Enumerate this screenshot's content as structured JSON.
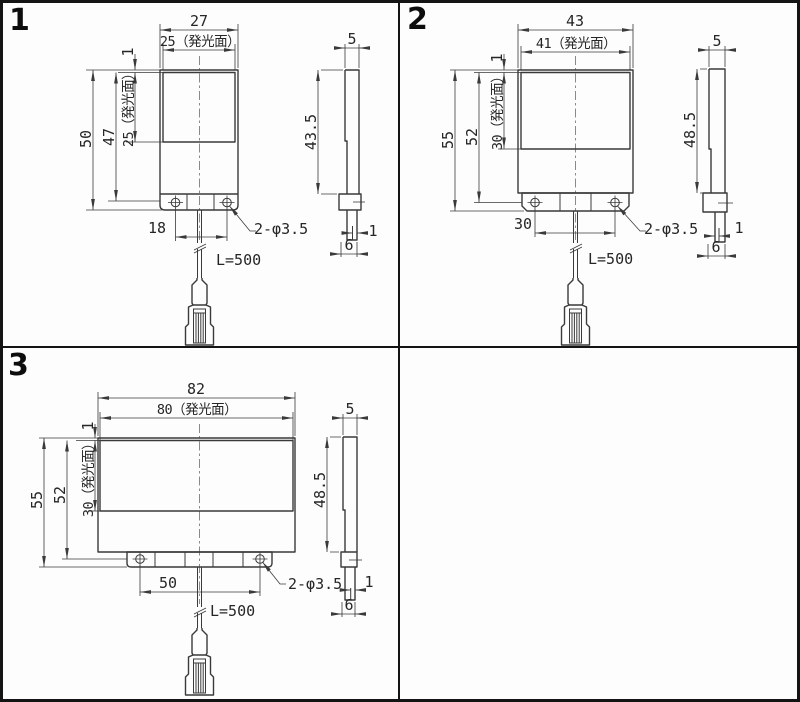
{
  "document": {
    "type": "technical-dimension-drawing",
    "language": "ja",
    "colors": {
      "line": "#3a3a3a",
      "text": "#262626",
      "border": "#141414",
      "background": "#fdfdfd"
    }
  },
  "panels": [
    {
      "label": "1",
      "front": {
        "width_total": "27",
        "width_emit": "25（発光面）",
        "gap_top": "1",
        "height_emit": "25（発光面）",
        "height_inner": "47",
        "height_total": "50",
        "hole_pitch": "18",
        "hole_note": "2-φ3.5",
        "cable_len": "L=500"
      },
      "side": {
        "width": "5",
        "height": "43.5",
        "edge_gap": "1",
        "foot_width": "6"
      }
    },
    {
      "label": "2",
      "front": {
        "width_total": "43",
        "width_emit": "41（発光面）",
        "gap_top": "1",
        "height_emit": "30（発光面）",
        "height_inner": "52",
        "height_total": "55",
        "hole_pitch": "30",
        "hole_note": "2-φ3.5",
        "cable_len": "L=500"
      },
      "side": {
        "width": "5",
        "height": "48.5",
        "edge_gap": "1",
        "foot_width": "6"
      }
    },
    {
      "label": "3",
      "front": {
        "width_total": "82",
        "width_emit": "80（発光面）",
        "gap_top": "1",
        "height_emit": "30（発光面）",
        "height_inner": "52",
        "height_total": "55",
        "hole_pitch": "50",
        "hole_note": "2-φ3.5",
        "cable_len": "L=500"
      },
      "side": {
        "width": "5",
        "height": "48.5",
        "edge_gap": "1",
        "foot_width": "6"
      }
    }
  ]
}
